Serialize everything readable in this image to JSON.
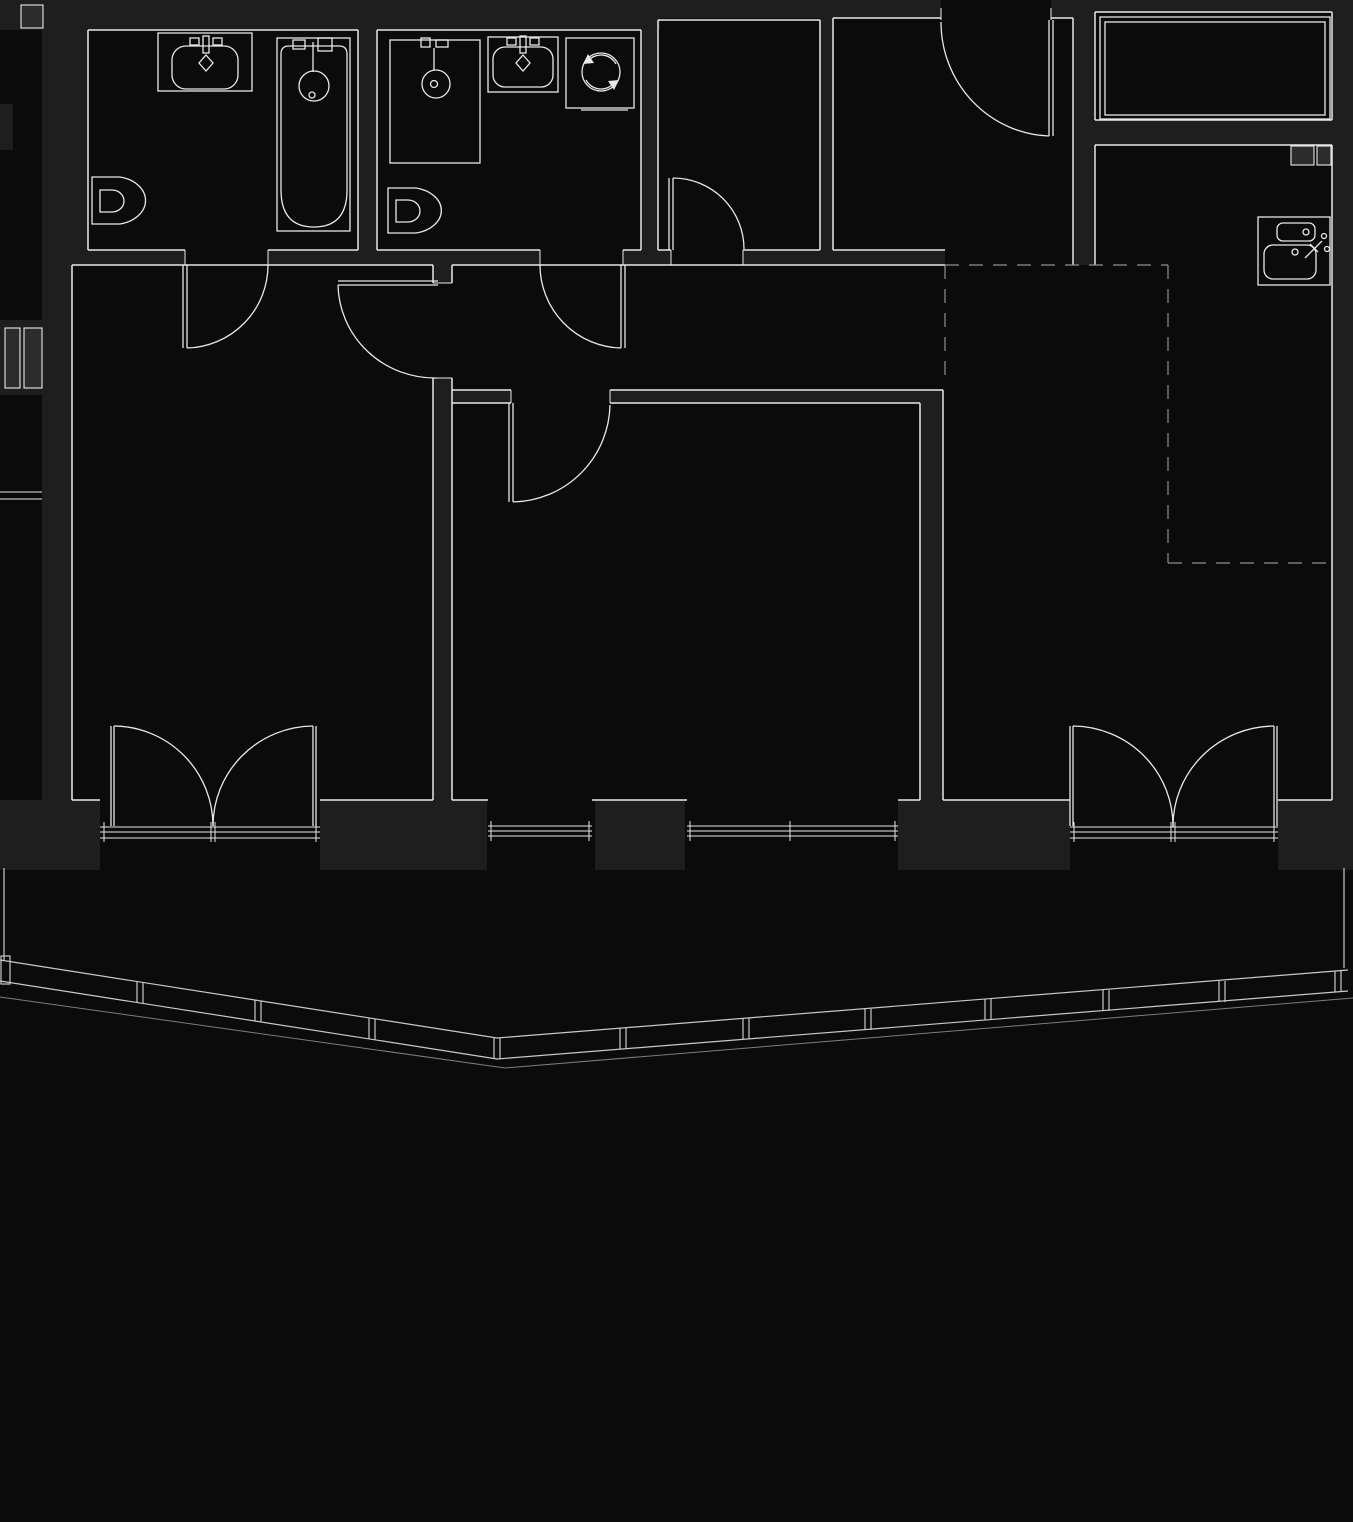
{
  "canvas": {
    "width": 1353,
    "height": 1522
  },
  "palette": {
    "bg": "#0b0b0b",
    "wall": "#1e1e1e",
    "line": "#e8e8e8",
    "shaft": "#2c2c2c",
    "dashed": "#8f8f8f",
    "rail": "#c9c9c9",
    "raildim": "#7d7d7d"
  },
  "plan": {
    "type": "apartment-floor-plan",
    "rooms": [
      {
        "name": "bathroom-1",
        "fixtures": [
          "vanity-sink",
          "bathtub",
          "toilet"
        ]
      },
      {
        "name": "bathroom-2",
        "fixtures": [
          "shower-tray",
          "vanity-sink",
          "washing-machine",
          "toilet"
        ]
      },
      {
        "name": "storage-closet",
        "fixtures": []
      },
      {
        "name": "entry-hall",
        "fixtures": []
      },
      {
        "name": "wardrobe-room",
        "fixtures": [
          "wardrobe"
        ]
      },
      {
        "name": "hallway",
        "fixtures": []
      },
      {
        "name": "bedroom-1",
        "fixtures": []
      },
      {
        "name": "bedroom-2",
        "fixtures": []
      },
      {
        "name": "living-kitchen",
        "fixtures": [
          "kitchen-sink"
        ]
      },
      {
        "name": "balcony",
        "fixtures": [
          "railing"
        ]
      }
    ],
    "doors": [
      {
        "name": "entry-door",
        "type": "single-swing"
      },
      {
        "name": "bathroom-1-door",
        "type": "single-swing"
      },
      {
        "name": "bathroom-2-door",
        "type": "single-swing"
      },
      {
        "name": "closet-door",
        "type": "single-swing"
      },
      {
        "name": "bedroom-1-door",
        "type": "single-swing"
      },
      {
        "name": "bedroom-2-door",
        "type": "single-swing"
      },
      {
        "name": "bedroom-1-balcony-door",
        "type": "double-french"
      },
      {
        "name": "living-balcony-door",
        "type": "double-french"
      }
    ],
    "windows": [
      {
        "name": "bedroom-2-window-left"
      },
      {
        "name": "bedroom-2-window-right"
      },
      {
        "name": "side-wall-window-mark"
      }
    ],
    "zones": [
      {
        "name": "kitchen-zone",
        "style": "dashed-outline"
      }
    ],
    "shafts": [
      {
        "name": "shaft-left",
        "cells": 2
      },
      {
        "name": "shaft-top-left",
        "cells": 1
      },
      {
        "name": "shaft-right",
        "cells": 2
      }
    ],
    "balcony": {
      "railing_segments": 12,
      "railing_posts": 11,
      "shape": "angled-polyline"
    }
  }
}
